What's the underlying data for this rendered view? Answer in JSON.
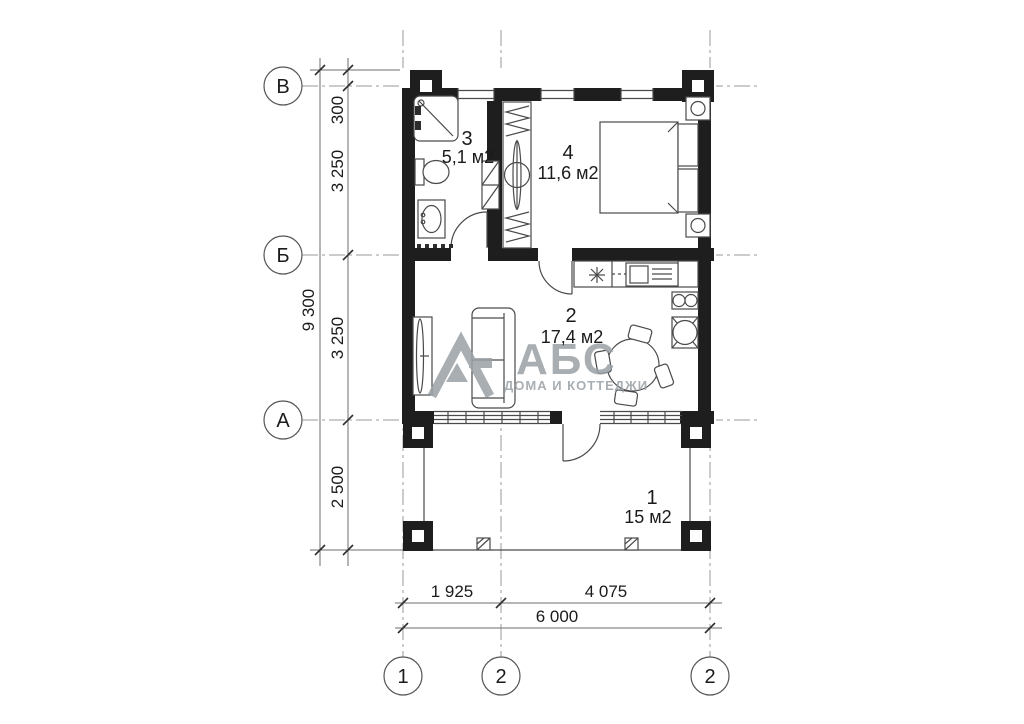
{
  "plan": {
    "axis_rows": [
      {
        "label": "В"
      },
      {
        "label": "Б"
      },
      {
        "label": "А"
      }
    ],
    "axis_cols": [
      {
        "label": "1"
      },
      {
        "label": "2"
      },
      {
        "label": "2"
      }
    ],
    "dims": {
      "left_total": "9 300",
      "left_segments": [
        "300",
        "3 250",
        "3 250",
        "2 500"
      ],
      "bottom_segments": [
        "1 925",
        "4 075"
      ],
      "bottom_total": "6 000"
    },
    "rooms": [
      {
        "number": "3",
        "area": "5,1 м2"
      },
      {
        "number": "4",
        "area": "11,6 м2"
      },
      {
        "number": "2",
        "area": "17,4 м2"
      },
      {
        "number": "1",
        "area": "15 м2"
      }
    ],
    "logo": {
      "title": "АБС",
      "subtitle": "ДОМА И КОТТЕДЖИ"
    }
  },
  "colors": {
    "wall": "#1e1e1e",
    "line": "#4a4a4a",
    "axis_line": "#9a9a9a",
    "dim_line": "#6e6e6e",
    "text": "#1b1b1b",
    "logo": "#9aa0a5",
    "background": "#ffffff"
  }
}
